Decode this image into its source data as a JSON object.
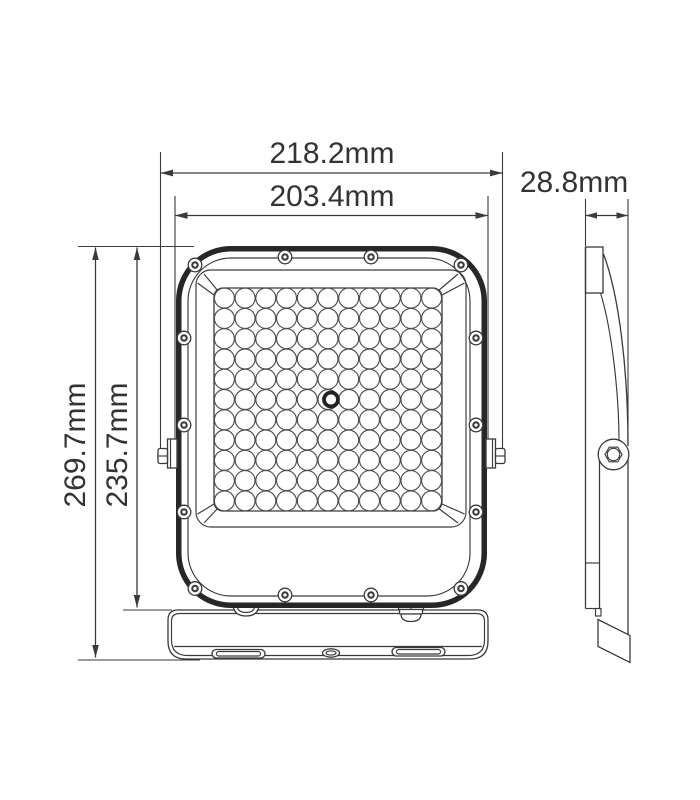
{
  "dimensions": {
    "width_outer": {
      "label": "218.2mm"
    },
    "width_inner": {
      "label": "203.4mm"
    },
    "depth": {
      "label": "28.8mm"
    },
    "height_outer": {
      "label": "269.7mm"
    },
    "height_inner": {
      "label": "235.7mm"
    }
  },
  "front_view": {
    "led_grid": {
      "rows": 11,
      "cols": 11,
      "center_hole": true
    },
    "screw_count": 14,
    "mounting_slots": 2
  },
  "colors": {
    "line": "#3a3a3a",
    "frame": "#272727",
    "text": "#333333",
    "background": "#ffffff"
  }
}
